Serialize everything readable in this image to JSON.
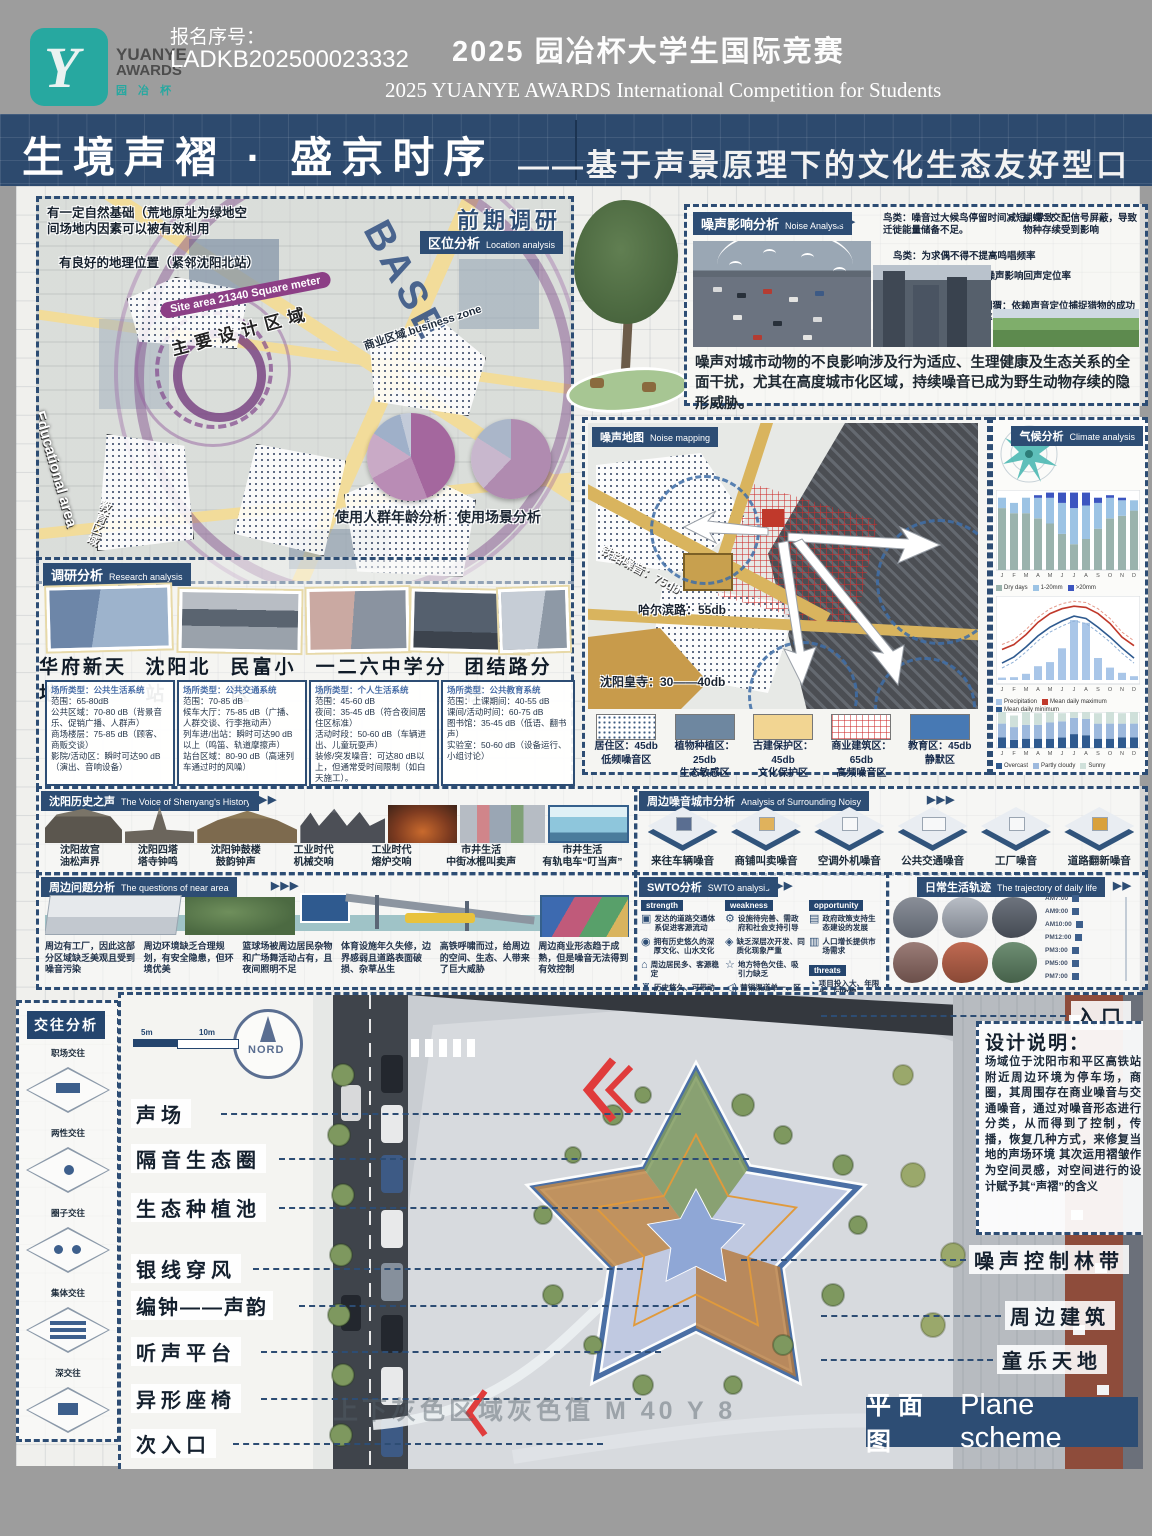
{
  "header": {
    "reg_label": "报名序号：",
    "reg_no": "LADKB202500023332",
    "title_cn": "2025 园冶杯大学生国际竞赛",
    "title_en": "2025 YUANYE AWARDS International Competition for  Students",
    "logo_line1": "YUANYE",
    "logo_line2": "AWARDS",
    "logo_line3": "园 冶 杯"
  },
  "banner": {
    "title": "生境声褶 · 盛京时序",
    "subtitle": "——基于声景原理下的文化生态友好型口袋公园"
  },
  "location": {
    "stage": "前期调研",
    "tag": "区位分析",
    "tag_en": "Location analysis",
    "note1": "有一定自然基础（荒地原址为绿地空间场地内因素可以被有效利用",
    "note2": "有良好的地理位置（紧邻沈阳北站）",
    "site_area": "Site area 21340 Square meter",
    "base": "BASE",
    "design_zone": "主要设计区域",
    "business_zone": "商业区域 business zone",
    "edu_en": "Educational area",
    "edu_cn": "教育区域",
    "pie1_title": "使用人群年龄分析",
    "pie2_title": "使用场景分析"
  },
  "research": {
    "tag": "调研分析",
    "tag_en": "Research analysis",
    "names": [
      "华府新天地",
      "沈阳北站",
      "民富小区",
      "一二六中学分校",
      "团结路分校"
    ],
    "boxes": [
      {
        "l0": "场所类型：公共生活系统",
        "l1": "范围：65-80dB",
        "l2": "公共区域：70-80 dB（背景音乐、促销广播、人群声）",
        "l3": "商场楼层：75-85 dB（顾客、商贩交谈）",
        "l4": "影院/活动区：瞬时可达90 dB（演出、音响设备）"
      },
      {
        "l0": "场所类型：公共交通系统",
        "l1": "范围：70-85 dB",
        "l2": "候车大厅：75-85 dB（广播、人群交谈、行李拖动声）",
        "l3": "列车进/出站：瞬时可达90 dB以上（鸣笛、轨道摩擦声）",
        "l4": "站台区域：80-90 dB（高速列车通过时的风噪）"
      },
      {
        "l0": "场所类型：个人生活系统",
        "l1": "范围：45-60 dB",
        "l2": "夜间：35-45 dB（符合夜间居住区标准）",
        "l3": "活动时段：50-60 dB（车辆进出、儿童玩耍声）",
        "l4": "装修/突发噪音：可达80 dB以上，但通常受时间限制（如白天施工）。"
      },
      {
        "l0": "场所类型：公共教育系统",
        "l1": "范围：上课期间：40-55 dB",
        "l2": "课间/活动时间：60-75 dB",
        "l3": "图书馆：35-45 dB（低语、翻书声）",
        "l4": "实验室：50-60 dB（设备运行、小组讨论）"
      }
    ]
  },
  "noise_analysis": {
    "tag": "噪声影响分析",
    "tag_en": "Noise Analysis",
    "c1": "鸟类：噪音过大候鸟停留时间减短，导致迁徙能量储备不足。",
    "c2": "鸟类：为求偶不得不提高鸣唱频率",
    "c3": "蝙蝠：空调外机噪声影响回声定位率",
    "c4": "蝴蝶：交配信号屏蔽，导致物种存续受到影响",
    "c5": "刺猬：依赖声音定位捕捉猎物的成功率降低",
    "summary": "噪声对城市动物的不良影响涉及行为适应、生理健康及生态关系的全面干扰，尤其在高度城市化区域，持续噪音已成为野生动物存续的隐形威胁。"
  },
  "noise_map": {
    "tag": "噪声地图",
    "tag_en": "Noise mapping",
    "label_rail": "铁路噪音：75db",
    "label_road": "哈尔滨路：55db",
    "label_temple": "沈阳皇寺：30——40db",
    "legend": [
      {
        "name": "居住区：45db",
        "sub": "低频噪音区"
      },
      {
        "name": "植物种植区：25db",
        "sub": "生态敏感区"
      },
      {
        "name": "古建保护区：45db",
        "sub": "文化保护区"
      },
      {
        "name": "商业建筑区：65db",
        "sub": "高频噪音区"
      },
      {
        "name": "教育区：45db",
        "sub": "静默区"
      }
    ]
  },
  "climate": {
    "tag": "气候分析",
    "tag_en": "Climate analysis"
  },
  "history": {
    "tag": "沈阳历史之声",
    "tag_en": "The Voice of Shenyang's History",
    "items": [
      {
        "t": "沈阳故宫",
        "s": "油松声界"
      },
      {
        "t": "沈阳四塔",
        "s": "塔寺钟鸣"
      },
      {
        "t": "沈阳钟鼓楼",
        "s": "鼓韵钟声"
      },
      {
        "t": "工业时代",
        "s": "机械交响"
      },
      {
        "t": "工业时代",
        "s": "熔炉交响"
      },
      {
        "t": "市井生活",
        "s": "中街冰棍叫卖声"
      },
      {
        "t": "市井生活",
        "s": "有轨电车“叮当声”"
      }
    ]
  },
  "surrounding": {
    "tag": "周边噪音城市分析",
    "tag_en": "Analysis of Surrounding Noisy",
    "items": [
      "来往车辆噪音",
      "商铺叫卖噪音",
      "空调外机噪音",
      "公共交通噪音",
      "工厂噪音",
      "道路翻新噪音"
    ]
  },
  "questions": {
    "tag": "周边问题分析",
    "tag_en": "The questions of near area",
    "items": [
      "周边有工厂，因此这部分区域缺乏美观且受到噪音污染",
      "周边环境缺乏合理规划，有安全隐患，但环境优美",
      "篮球场被周边居民杂物和广场舞活动占有，且夜间照明不足",
      "体育设施年久失修，边界感弱且道路表面破损、杂草丛生",
      "高铁呼啸而过，给周边的空间、生态、人带来了巨大威胁",
      "周边商业形态趋于成熟，但是噪音无法得到有效控制"
    ]
  },
  "swto": {
    "tag": "SWTO分析",
    "tag_en": "SWTO analysis",
    "s_label": "strength",
    "w_label": "weakness",
    "o_label": "opportunity",
    "t_label": "threats",
    "s_items": [
      "发达的道路交通体系促进客源流动",
      "拥有历史悠久的深厚文化、山水文化",
      "周边居民多、客源稳定",
      "历史悠久、可带动发展"
    ],
    "w_items": [
      "设施待完善、需政府和社会支持引导",
      "缺乏深层次开发、同质化现象严重",
      "地方特色欠佳、吸引力缺乏",
      "营销渠道单一、区域品牌影响力缺乏"
    ],
    "o_items": [
      "政府政策支持生态建设的发展",
      "人口增长提供市场需求"
    ],
    "t_items": [
      "项目投入大、年限长、回收慢",
      "开发中的生态平衡遭到破坏"
    ]
  },
  "daily": {
    "tag": "日常生活轨迹",
    "tag_en": "The trajectory of daily life",
    "times": [
      "AM7:00",
      "AM9:00",
      "AM10:00",
      "PM12:00",
      "PM3:00",
      "PM5:00",
      "PM7:00"
    ]
  },
  "interaction": {
    "tag": "交往分析",
    "items": [
      "职场交往",
      "两性交往",
      "圈子交往",
      "集体交往",
      "深交往"
    ]
  },
  "plan": {
    "labels_left": [
      "声场",
      "隔音生态圈",
      "生态种植池",
      "银线穿风",
      "编钟——声韵",
      "听声平台",
      "异形座椅",
      "次入口"
    ],
    "label_entry": "入口",
    "labels_right": [
      "噪声控制林带",
      "周边建筑",
      "童乐天地"
    ],
    "note_title": "设计说明：",
    "note_body": "场域位于沈阳市和平区高铁站附近周边环境为停车场，商圈，其周围存在商业噪音与交通噪音，通过对噪音形态进行分类，从而得到了控制，传播，恢复几种方式，来修复当地的声场环境 其次运用褶皱作为空间灵感，对空间进行的设计赋予其“声褶”的含义",
    "compass": "NORD",
    "scale_a": "5m",
    "scale_b": "10m",
    "banner_cn": "平 面 图",
    "banner_en": "Plane scheme",
    "watermark": "上下灰色区域灰色值 M 40 Y 8"
  },
  "chart_data": [
    {
      "type": "pie",
      "title": "使用人群年龄分析",
      "values": [
        44,
        23,
        17,
        12,
        4
      ],
      "colors": [
        "#a4679e",
        "#b98cb5",
        "#c9aac6",
        "#9fb0c9",
        "#c3cbd9"
      ]
    },
    {
      "type": "pie",
      "title": "使用场景分析",
      "values": [
        62,
        22,
        16
      ],
      "colors": [
        "#b08bb0",
        "#c8b7cd",
        "#aab6c9"
      ]
    },
    {
      "type": "bar",
      "subtype": "stacked",
      "title": "Precipitation days",
      "months": [
        "J",
        "F",
        "M",
        "A",
        "M",
        "J",
        "J",
        "A",
        "S",
        "O",
        "N",
        "D"
      ],
      "series": [
        {
          "name": "Dry days",
          "color": "#9ab3ad",
          "values": [
            24,
            22,
            22,
            20,
            18,
            14,
            10,
            12,
            16,
            20,
            21,
            23
          ]
        },
        {
          "name": "1-20mm",
          "color": "#9cc3e4",
          "values": [
            4,
            4,
            6,
            8,
            10,
            12,
            14,
            13,
            10,
            8,
            6,
            4
          ]
        },
        {
          "name": ">20mm",
          "color": "#3c55c0",
          "values": [
            0,
            0,
            0,
            1,
            2,
            4,
            6,
            5,
            2,
            1,
            1,
            0
          ]
        }
      ],
      "ylim": [
        0,
        31
      ]
    },
    {
      "type": "line+bar",
      "title": "Temperature and precipitation",
      "months": [
        "J",
        "F",
        "M",
        "A",
        "M",
        "J",
        "J",
        "A",
        "S",
        "O",
        "N",
        "D"
      ],
      "tmax": [
        -5,
        -1,
        7,
        17,
        24,
        28,
        30,
        29,
        24,
        16,
        5,
        -2
      ],
      "tmin": [
        -16,
        -11,
        -3,
        6,
        13,
        18,
        22,
        20,
        13,
        5,
        -4,
        -12
      ],
      "precip_mm": [
        7,
        8,
        18,
        40,
        52,
        92,
        174,
        166,
        64,
        36,
        21,
        11
      ],
      "legend": [
        "Precipitation",
        "Mean daily maximum",
        "Mean daily minimum"
      ]
    },
    {
      "type": "bar",
      "subtype": "stacked",
      "title": "Cloudy, sunny days",
      "months": [
        "J",
        "F",
        "M",
        "A",
        "M",
        "J",
        "J",
        "A",
        "S",
        "O",
        "N",
        "D"
      ],
      "series": [
        {
          "name": "Overcast",
          "color": "#2f5a8f",
          "values": [
            9,
            7,
            8,
            8,
            8,
            9,
            12,
            11,
            8,
            8,
            9,
            9
          ]
        },
        {
          "name": "Partly cloudy",
          "color": "#9db9dd",
          "values": [
            12,
            11,
            12,
            12,
            14,
            14,
            14,
            14,
            13,
            13,
            12,
            12
          ]
        },
        {
          "name": "Sunny",
          "color": "#cfe0da",
          "values": [
            10,
            10,
            11,
            10,
            9,
            7,
            5,
            6,
            9,
            10,
            9,
            10
          ]
        }
      ],
      "ylim": [
        0,
        31
      ]
    }
  ]
}
